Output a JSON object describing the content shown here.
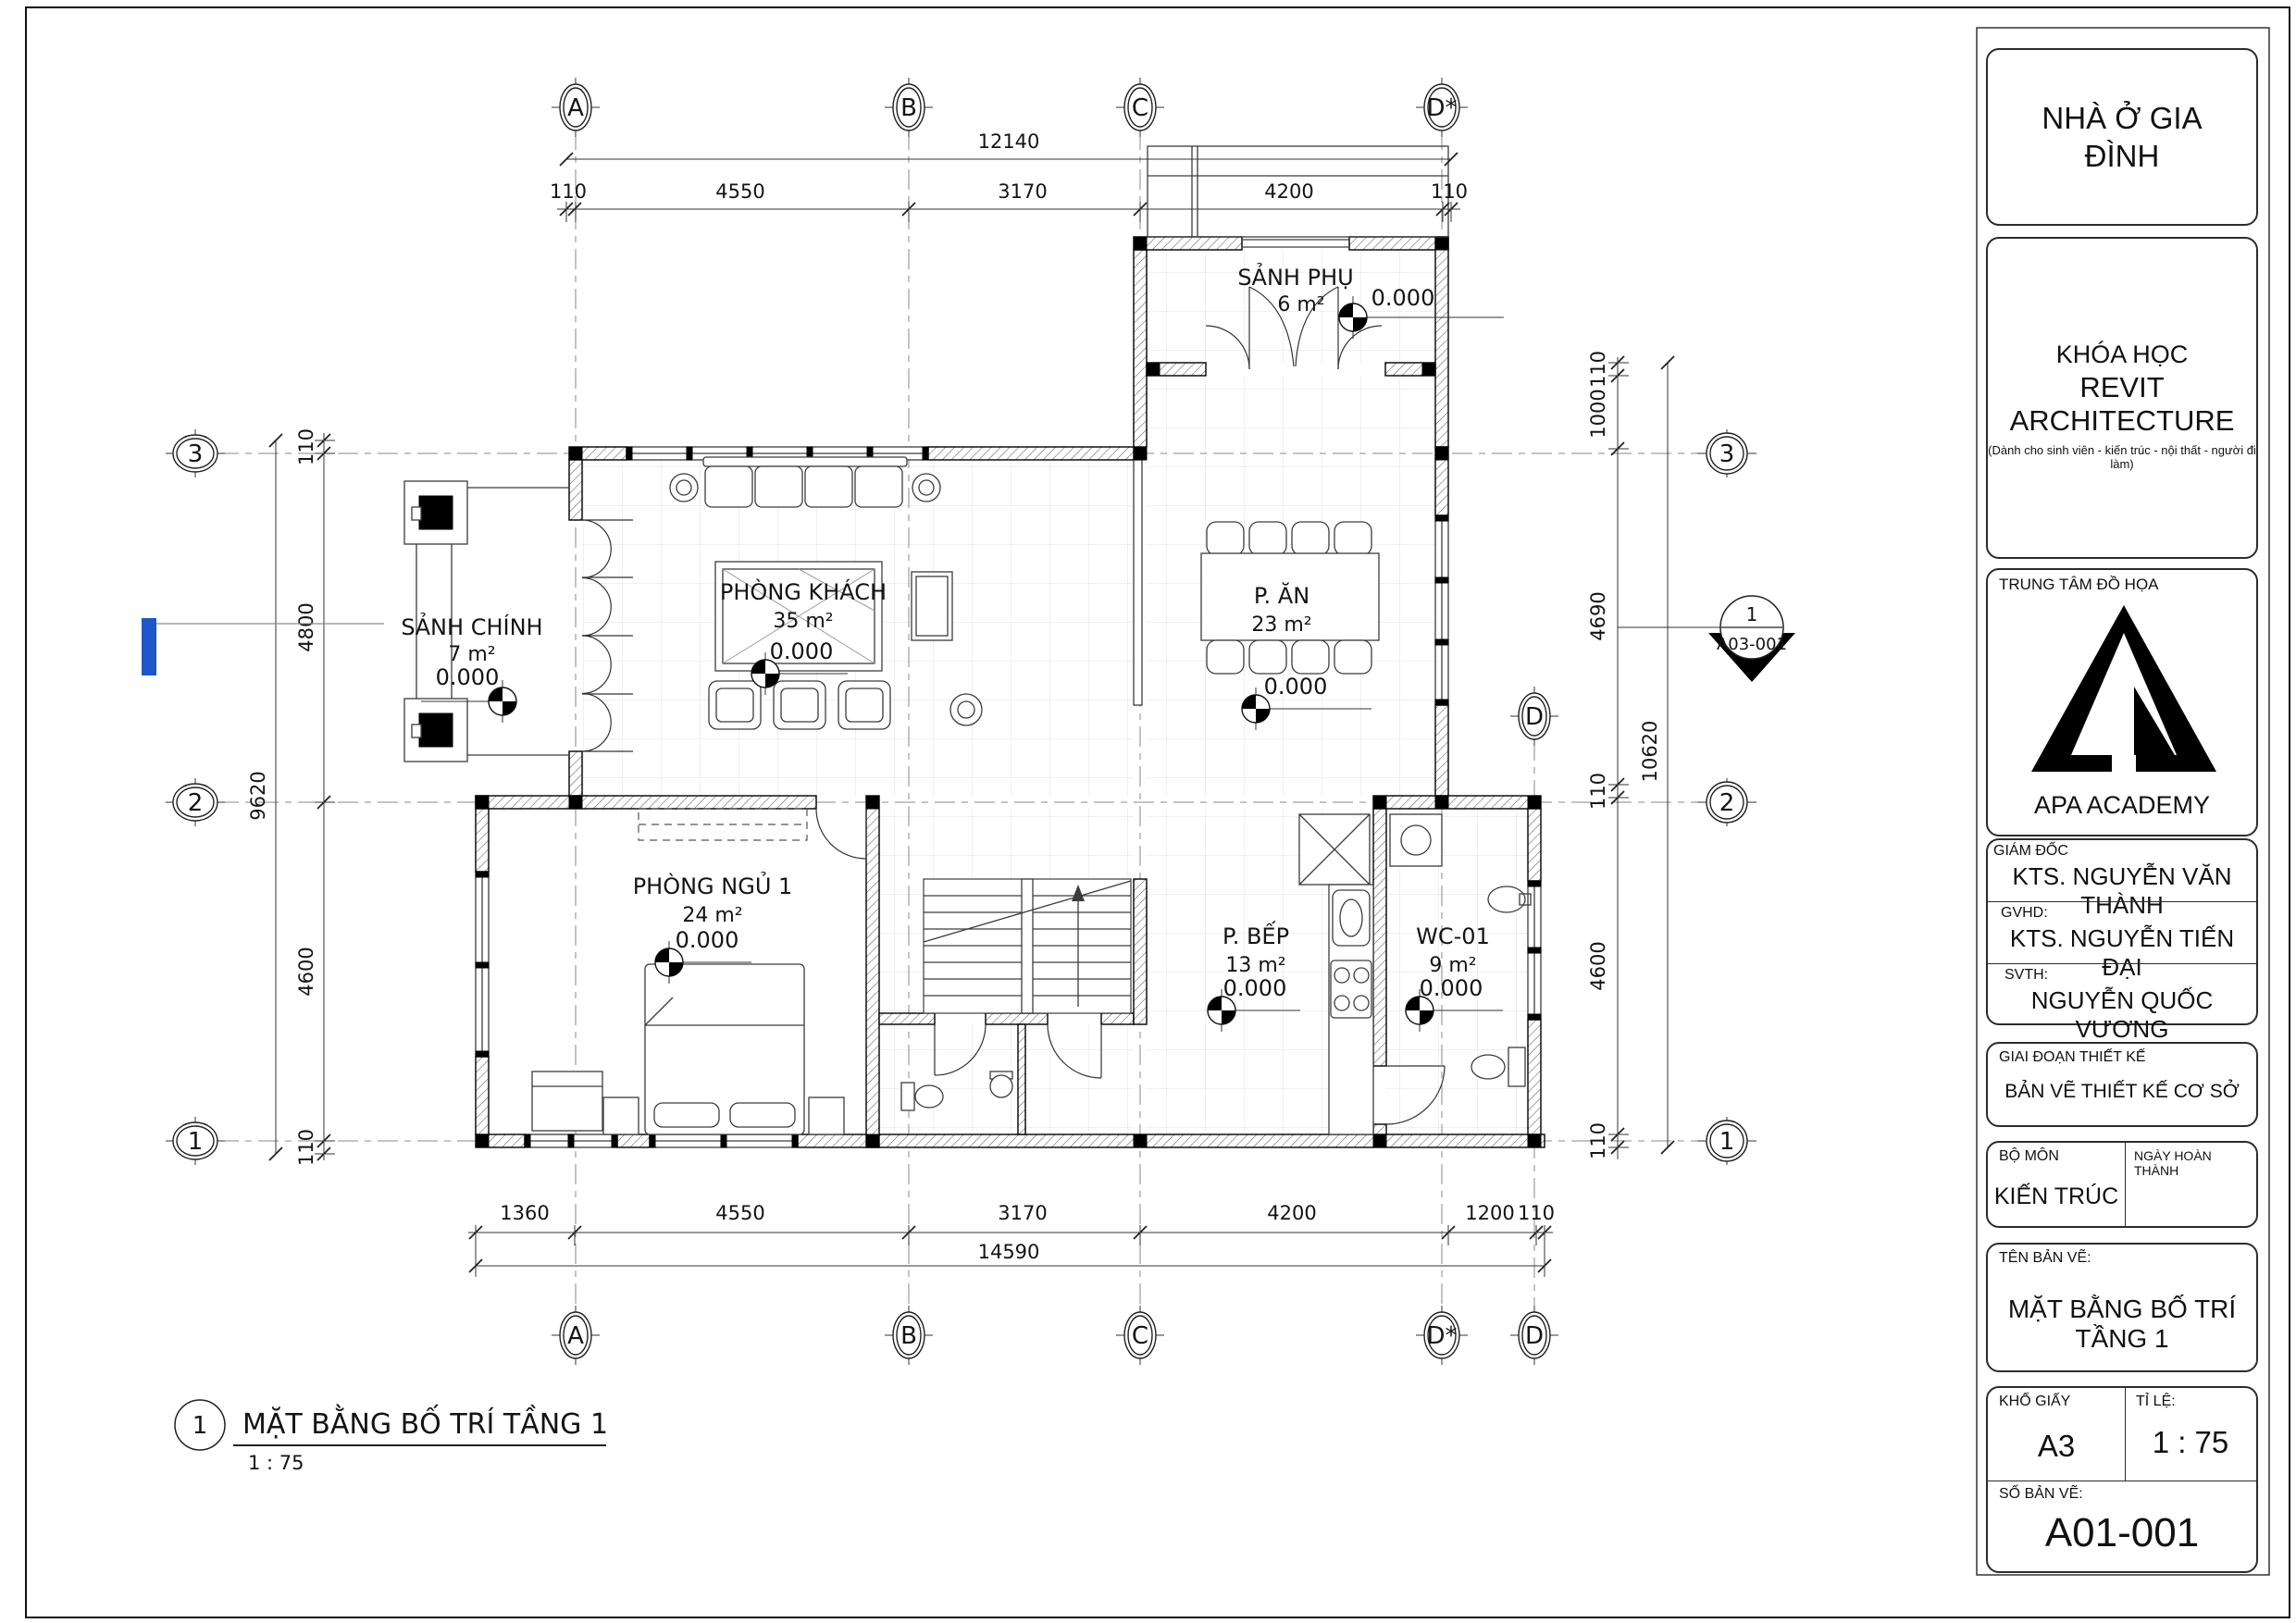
{
  "title_block": {
    "project": "NHÀ Ở GIA ĐÌNH",
    "course": {
      "line1": "KHÓA HỌC",
      "line2": "REVIT ARCHITECTURE",
      "note": "(Dành cho sinh viên - kiến trúc - nội thất - người đi làm)"
    },
    "center": {
      "label": "TRUNG TÂM ĐỒ HỌA",
      "academy": "APA ACADEMY"
    },
    "fields": {
      "director_label": "GIÁM ĐỐC",
      "director": "KTS. NGUYỄN VĂN THÀNH",
      "advisor_label": "GVHD:",
      "advisor": "KTS. NGUYỄN TIẾN ĐẠI",
      "student_label": "SVTH:",
      "student": "NGUYỄN QUỐC VƯƠNG",
      "phase_label": "GIAI ĐOẠN THIẾT KẾ",
      "phase": "BẢN VẼ THIẾT KẾ CƠ SỞ",
      "dept_label": "BỘ MÔN",
      "dept": "KIẾN TRÚC",
      "date_label": "NGÀY HOÀN THÀNH",
      "drawing_name_label": "TÊN BẢN VẼ:",
      "drawing_name": "MẶT BẰNG BỐ TRÍ TẦNG 1",
      "paper_label": "KHỔ GIẤY",
      "paper": "A3",
      "scale_label": "TỈ LỆ:",
      "scale": "1 : 75",
      "number_label": "SỐ BẢN VẼ:",
      "number": "A01-001"
    }
  },
  "view_title": {
    "num": "1",
    "name": "MẶT BẰNG BỐ TRÍ TẦNG 1",
    "scale": "1 : 75"
  },
  "plan": {
    "grids": {
      "cols": [
        "A",
        "B",
        "C",
        "D*",
        "D"
      ],
      "rows": [
        "3",
        "2",
        "1"
      ]
    },
    "rooms": {
      "sanh_phu": {
        "name": "SẢNH PHỤ",
        "area": "6 m²",
        "level": "0.000"
      },
      "p_an": {
        "name": "P. ĂN",
        "area": "23 m²",
        "level": "0.000"
      },
      "phong_khach": {
        "name": "PHÒNG KHÁCH",
        "area": "35 m²",
        "level": "0.000"
      },
      "sanh_chinh": {
        "name": "SẢNH CHÍNH",
        "area": "7 m²",
        "level": "0.000"
      },
      "phong_ngu_1": {
        "name": "PHÒNG NGỦ 1",
        "area": "24 m²",
        "level": "0.000"
      },
      "p_bep": {
        "name": "P. BẾP",
        "area": "13 m²",
        "level": "0.000"
      },
      "wc_01": {
        "name": "WC-01",
        "area": "9 m²",
        "level": "0.000"
      }
    },
    "dims": {
      "top_total": "12140",
      "top": [
        "110",
        "4550",
        "3170",
        "4200",
        "110"
      ],
      "bottom": [
        "1360",
        "4550",
        "3170",
        "4200",
        "1200",
        "110"
      ],
      "bottom_total": "14590",
      "left": [
        "110",
        "4800",
        "4600",
        "110"
      ],
      "left_total": "9620",
      "right": [
        "110",
        "1000",
        "4690",
        "110",
        "4600",
        "110"
      ],
      "right_total": "10620"
    },
    "callout": {
      "num": "1",
      "sheet": "A03-001"
    }
  },
  "colors": {
    "selection": "#1d56c8"
  }
}
